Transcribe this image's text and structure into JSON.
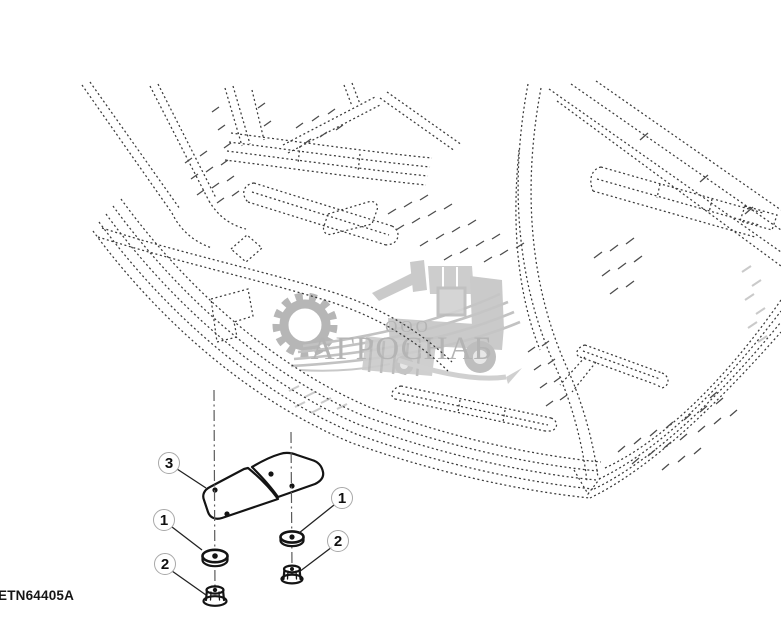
{
  "figure": {
    "part_code": "ETN64405A",
    "callouts": [
      {
        "label": "3"
      },
      {
        "label": "1"
      },
      {
        "label": "2"
      },
      {
        "label": "1"
      },
      {
        "label": "2"
      }
    ]
  },
  "watermark": {
    "org_type": "ООО",
    "org_name": "АГРОСНАБ",
    "gray": "#b6b6b6"
  },
  "drawing": {
    "line_color": "#3a3a3a",
    "part_names": {
      "1": "washer",
      "2": "flange-nut",
      "3": "mounting-plate"
    }
  }
}
